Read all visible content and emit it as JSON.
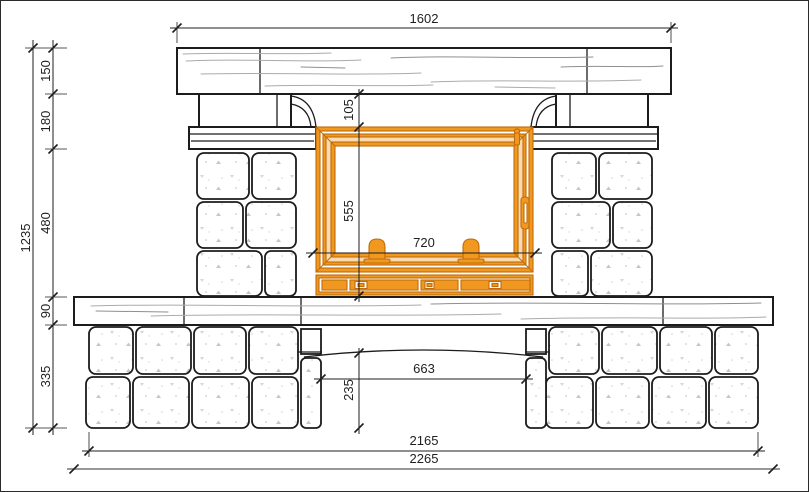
{
  "drawing": {
    "kind": "fireplace front elevation, dimensioned technical drawing"
  },
  "colors": {
    "line": "#1c1c1c",
    "dim": "#1f1f1f",
    "dim_gray": "#767676",
    "grain": "#ababab",
    "speckle": "#c6c6c6",
    "insert_stroke": "#c06c0b",
    "insert_fill": "#f0981f",
    "insert_fill_light": "#fbdcb2"
  },
  "dimensions": {
    "mantel_width": "1602",
    "total_height": "1235",
    "mantel_thickness": "150",
    "corbel_zone_height": "180",
    "firebox_zone_height": "480",
    "bench_thickness": "90",
    "base_height": "335",
    "insert_top_offset": "105",
    "insert_height": "555",
    "insert_width": "720",
    "opening_width": "663",
    "opening_height": "235",
    "base_width": "2165",
    "bench_width": "2265"
  }
}
